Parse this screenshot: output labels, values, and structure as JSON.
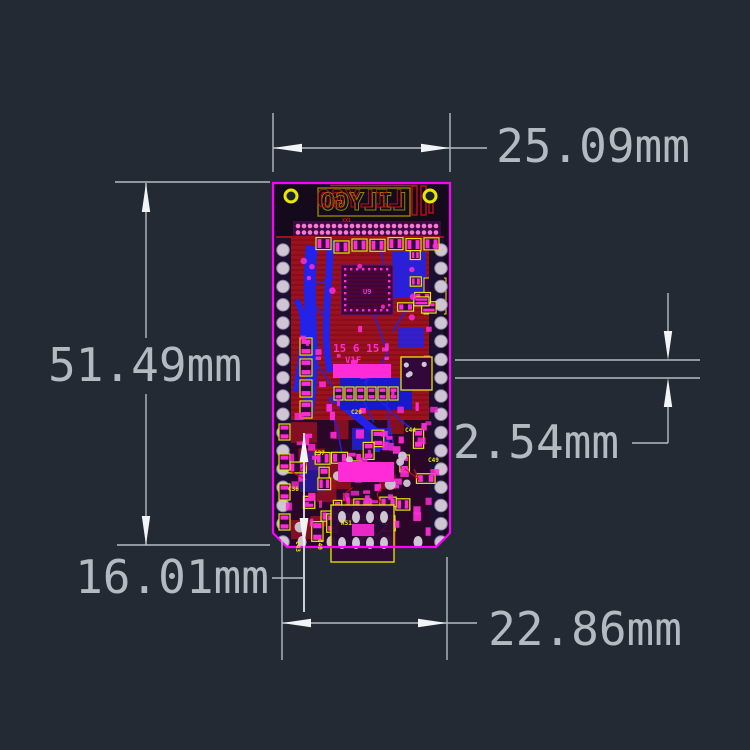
{
  "title": "PCB dimension drawing",
  "colors": {
    "background": "#232a33",
    "dim_line": "#b4bbc2",
    "dim_text": "#b2bac2",
    "arrow": "#f2f4f6"
  },
  "dimensions": {
    "top_width": {
      "label": "25.09mm"
    },
    "left_height": {
      "label": "51.49mm"
    },
    "right_pitch": {
      "label": "2.54mm"
    },
    "bottom_offset": {
      "label": "16.01mm"
    },
    "bottom_width": {
      "label": "22.86mm"
    }
  },
  "pcb": {
    "outline": {
      "x1": 273,
      "y1": 183,
      "x2": 450,
      "y2": 547,
      "chamfer": 14
    },
    "colors": {
      "outline": "#ff00ff",
      "substrate": "#140a1c",
      "pour": "#9c1120",
      "pour_dark": "#6e0a14",
      "trace_blue": "#2222e8",
      "pad_magenta": "#ff2bd6",
      "pad_pink": "#f77ad0",
      "silk_yellow": "#e8e800",
      "silk_olive": "#8f8400",
      "logo_red": "#cc1111",
      "ic_purple": "#3c0440",
      "purple_dark": "#30083a",
      "gray_pad": "#cfc6d4"
    },
    "logo": {
      "text": "LILYGO"
    },
    "labels": [
      {
        "t": "15 6 15",
        "x": 333,
        "y": 352,
        "s": 11,
        "c": "#ff2bd6"
      },
      {
        "t": "V1F",
        "x": 345,
        "y": 363,
        "s": 9,
        "c": "#ff2bd6"
      },
      {
        "t": "U9",
        "x": 363,
        "y": 294,
        "s": 7,
        "c": "#ff2bd6"
      },
      {
        "t": "XX1",
        "x": 342,
        "y": 222,
        "s": 5,
        "c": "#cc1111"
      },
      {
        "t": "C20",
        "x": 351,
        "y": 414,
        "s": 6,
        "c": "#e8e800"
      },
      {
        "t": "C37",
        "x": 314,
        "y": 455,
        "s": 6,
        "c": "#e8e800"
      },
      {
        "t": "C44",
        "x": 405,
        "y": 432,
        "s": 6,
        "c": "#e8e800"
      },
      {
        "t": "C36",
        "x": 288,
        "y": 491,
        "s": 6,
        "c": "#e8e800"
      },
      {
        "t": "C40",
        "x": 318,
        "y": 539,
        "s": 6,
        "c": "#e8e800",
        "r": 90
      },
      {
        "t": "C43",
        "x": 296,
        "y": 541,
        "s": 6,
        "c": "#e8e800",
        "r": 90
      },
      {
        "t": "R51",
        "x": 341,
        "y": 525,
        "s": 6,
        "c": "#e8e800"
      },
      {
        "t": "C49",
        "x": 428,
        "y": 462,
        "s": 6,
        "c": "#e8e800"
      }
    ]
  }
}
